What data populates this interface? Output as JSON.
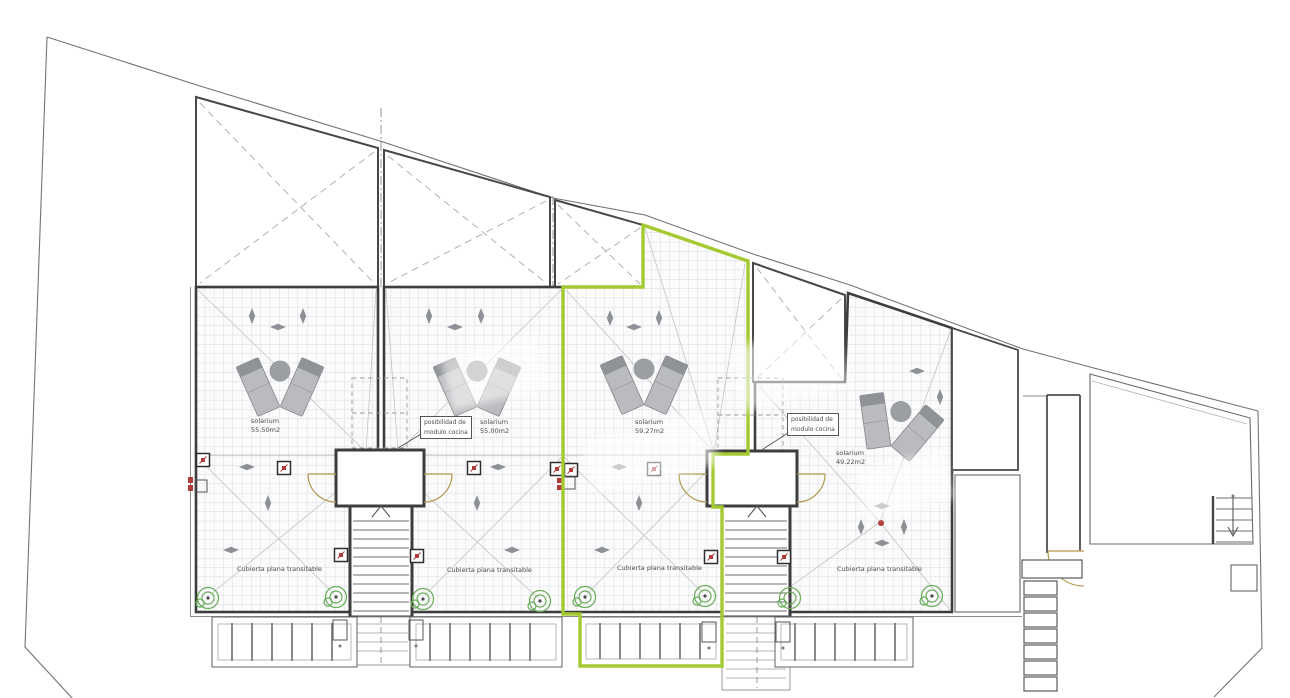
{
  "plan": {
    "units": [
      {
        "name": "solarium",
        "area": "55.50m2",
        "roof_label": "Cubierta plana transitable",
        "highlighted": false
      },
      {
        "name": "solarium",
        "area": "55.00m2",
        "roof_label": "Cubierta plana transitable",
        "highlighted": false
      },
      {
        "name": "solarium",
        "area": "59.27m2",
        "roof_label": "Cubierta plana transitable",
        "highlighted": true
      },
      {
        "name": "solarium",
        "area": "49.22m2",
        "roof_label": "Cubierta plana transitable",
        "highlighted": false
      }
    ],
    "annotations": {
      "kitchen_notes": [
        {
          "line1": "posibilidad de",
          "line2": "modulo cocina"
        },
        {
          "line1": "posibilidad de",
          "line2": "modulo cocina"
        }
      ]
    },
    "legend_icons": {
      "drain_plant": "green-concentric-circles",
      "scupper_marker": "small-red-x-box",
      "slope_arrow": "gray-diamond-arrow",
      "stairs_up": "chevron-up",
      "stairs_down": "arrow-down",
      "door_swing": "quarter-arc"
    },
    "colors": {
      "highlight": "#a4ca32",
      "door": "#b3984d",
      "marker_red": "#b13a3a",
      "drain_green": "#67ab57",
      "wall": "#3d3d3d",
      "grid": "#ccd0d8"
    }
  }
}
